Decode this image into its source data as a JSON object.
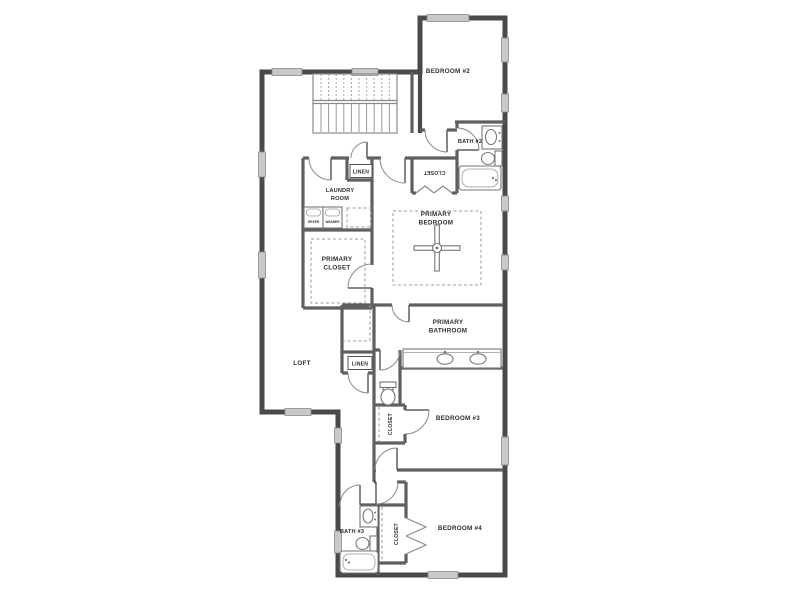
{
  "colors": {
    "wall": "#4a4a4a",
    "interior_wall": "#5f5f5f",
    "thin_line": "#8a8a8a",
    "window_fill": "#c9c9c9",
    "dashed_line": "#9a9a9a",
    "text": "#2e2e2e",
    "background": "#ffffff"
  },
  "rooms": {
    "bedroom2": {
      "label": "BEDROOM #2"
    },
    "bath2": {
      "label": "BATH #2"
    },
    "bath2_closet": {
      "label": "CLOSET"
    },
    "linen_upper": {
      "label": "LINEN"
    },
    "laundry": {
      "line1": "LAUNDRY",
      "line2": "ROOM"
    },
    "primary_bedroom": {
      "line1": "PRIMARY",
      "line2": "BEDROOM"
    },
    "primary_closet": {
      "line1": "PRIMARY",
      "line2": "CLOSET"
    },
    "loft": {
      "label": "LOFT"
    },
    "linen_lower": {
      "label": "LINEN"
    },
    "primary_bathroom": {
      "line1": "PRIMARY",
      "line2": "BATHROOM"
    },
    "bedroom3": {
      "label": "BEDROOM #3"
    },
    "bedroom3_closet": {
      "label": "CLOSET"
    },
    "bath3": {
      "label": "BATH #3"
    },
    "bedroom4_closet": {
      "label": "CLOSET"
    },
    "bedroom4": {
      "label": "BEDROOM #4"
    }
  },
  "appliances": {
    "dryer": "DRYER",
    "washer": "WASHER"
  },
  "fixtures_present": [
    "stairs-icon",
    "toilet-icon",
    "sink-icon",
    "bathtub-icon",
    "vanity-double-sink-icon",
    "washer-icon",
    "dryer-icon",
    "ceiling-fan-icon",
    "door-swing-icon",
    "bifold-door-icon",
    "window-icon"
  ]
}
